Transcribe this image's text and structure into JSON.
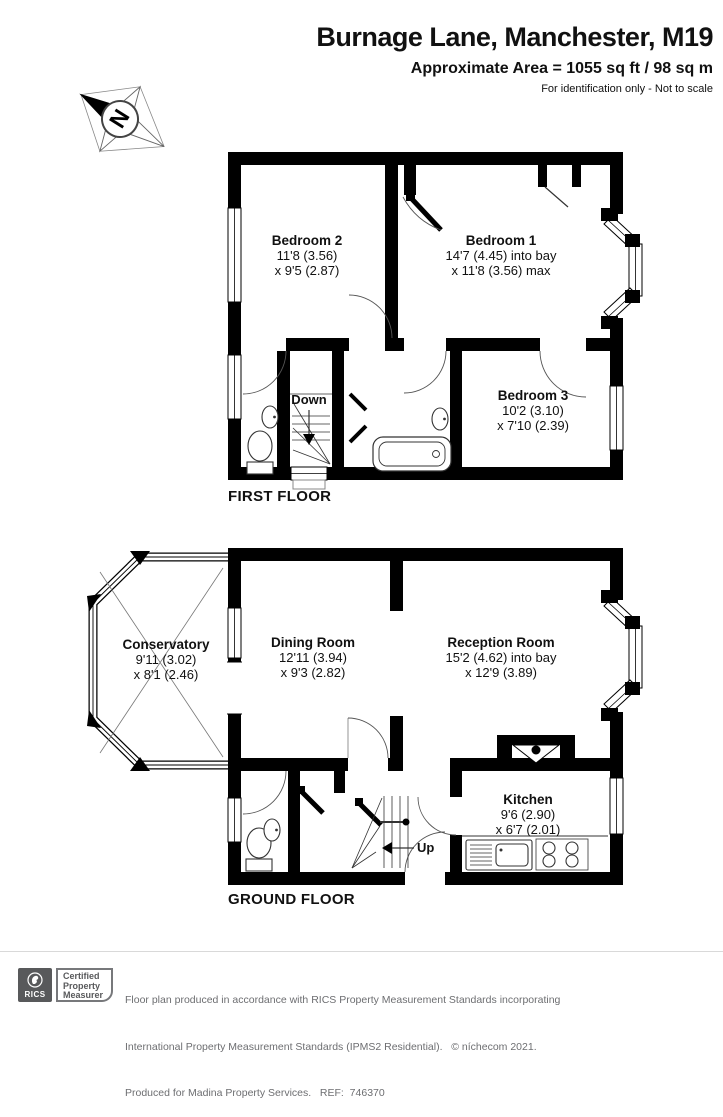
{
  "header": {
    "title": "Burnage Lane, Manchester, M19",
    "area": "Approximate Area = 1055 sq ft / 98 sq m",
    "note": "For identification only - Not to scale"
  },
  "compass": {
    "north": "N"
  },
  "floors": [
    {
      "label": "FIRST FLOOR",
      "stairs": "Down",
      "rooms": [
        {
          "name": "Bedroom 2",
          "dim1": "11'8 (3.56)",
          "dim2": "x 9'5 (2.87)"
        },
        {
          "name": "Bedroom 1",
          "dim1": "14'7 (4.45) into bay",
          "dim2": "x 11'8 (3.56) max"
        },
        {
          "name": "Bedroom 3",
          "dim1": "10'2 (3.10)",
          "dim2": "x 7'10 (2.39)"
        }
      ]
    },
    {
      "label": "GROUND FLOOR",
      "stairs": "Up",
      "rooms": [
        {
          "name": "Conservatory",
          "dim1": "9'11 (3.02)",
          "dim2": "x 8'1 (2.46)"
        },
        {
          "name": "Dining Room",
          "dim1": "12'11 (3.94)",
          "dim2": "x 9'3 (2.82)"
        },
        {
          "name": "Reception Room",
          "dim1": "15'2 (4.62) into bay",
          "dim2": "x 12'9 (3.89)"
        },
        {
          "name": "Kitchen",
          "dim1": "9'6 (2.90)",
          "dim2": "x 6'7 (2.01)"
        }
      ]
    }
  ],
  "footer": {
    "rics": "RICS",
    "badge1": "Certified",
    "badge2": "Property",
    "badge3": "Measurer",
    "line1": "Floor plan produced in accordance with RICS Property Measurement Standards incorporating",
    "line2": "International Property Measurement Standards (IPMS2 Residential).   © níchecom 2021.",
    "line3": "Produced for Madina Property Services.   REF:  746370"
  }
}
